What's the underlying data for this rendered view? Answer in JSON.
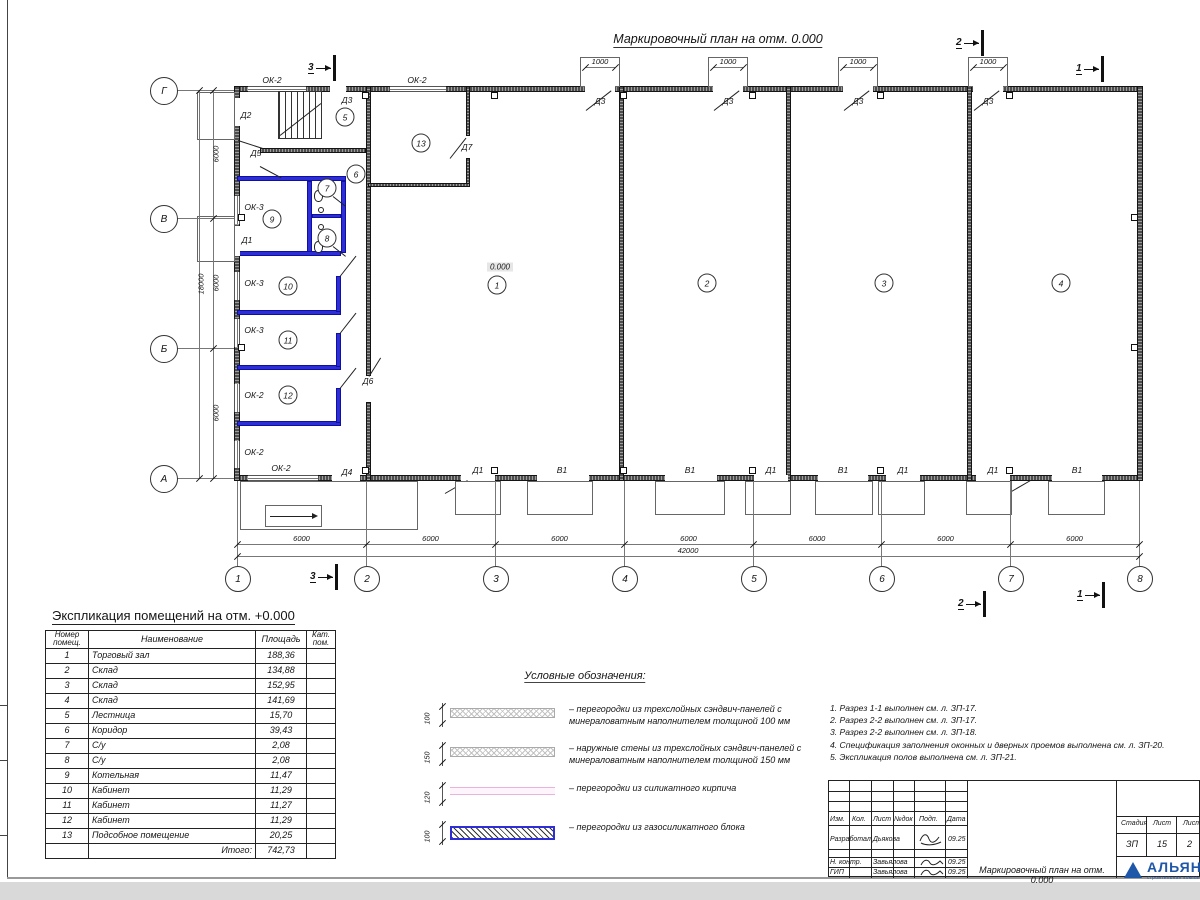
{
  "title": "Маркировочный план на отм. 0.000",
  "colors": {
    "wall_dark": "#4d4d4d",
    "wall_blue": "#2e2ed8",
    "legend_pink": "#e8b4dc",
    "logo_blue": "#1e57a8"
  },
  "plan": {
    "elevation_mark": "0.000",
    "grid_cols": [
      {
        "label": "1",
        "x": 237
      },
      {
        "label": "2",
        "x": 366
      },
      {
        "label": "3",
        "x": 495
      },
      {
        "label": "4",
        "x": 624
      },
      {
        "label": "5",
        "x": 753
      },
      {
        "label": "6",
        "x": 881
      },
      {
        "label": "7",
        "x": 1010
      },
      {
        "label": "8",
        "x": 1139
      }
    ],
    "grid_rows": [
      {
        "label": "Г",
        "y": 90
      },
      {
        "label": "В",
        "y": 218
      },
      {
        "label": "Б",
        "y": 348
      },
      {
        "label": "А",
        "y": 478
      }
    ],
    "bottom_dims": {
      "bay": "6000",
      "total": "42000"
    },
    "left_dims": {
      "bay": "6000",
      "total": "18000"
    },
    "top_openings": {
      "dim": "1000",
      "centers": [
        600,
        728,
        858,
        988
      ]
    },
    "room_circles": [
      {
        "n": "1",
        "x": 497,
        "y": 285
      },
      {
        "n": "2",
        "x": 707,
        "y": 283
      },
      {
        "n": "3",
        "x": 884,
        "y": 283
      },
      {
        "n": "4",
        "x": 1061,
        "y": 283
      },
      {
        "n": "5",
        "x": 345,
        "y": 117
      },
      {
        "n": "6",
        "x": 356,
        "y": 174
      },
      {
        "n": "7",
        "x": 327,
        "y": 188
      },
      {
        "n": "8",
        "x": 327,
        "y": 238
      },
      {
        "n": "9",
        "x": 272,
        "y": 219
      },
      {
        "n": "10",
        "x": 288,
        "y": 286
      },
      {
        "n": "11",
        "x": 288,
        "y": 340
      },
      {
        "n": "12",
        "x": 288,
        "y": 395
      },
      {
        "n": "13",
        "x": 421,
        "y": 143
      }
    ],
    "labels": [
      {
        "t": "ОК-2",
        "x": 272,
        "y": 80
      },
      {
        "t": "ОК-2",
        "x": 417,
        "y": 80
      },
      {
        "t": "Д3",
        "x": 347,
        "y": 100
      },
      {
        "t": "Д3",
        "x": 600,
        "y": 101
      },
      {
        "t": "Д3",
        "x": 728,
        "y": 101
      },
      {
        "t": "Д3",
        "x": 858,
        "y": 101
      },
      {
        "t": "Д3",
        "x": 988,
        "y": 101
      },
      {
        "t": "Д2",
        "x": 246,
        "y": 115
      },
      {
        "t": "Д5",
        "x": 256,
        "y": 153
      },
      {
        "t": "Д1",
        "x": 247,
        "y": 240
      },
      {
        "t": "ОК-3",
        "x": 254,
        "y": 207
      },
      {
        "t": "ОК-3",
        "x": 254,
        "y": 283
      },
      {
        "t": "ОК-3",
        "x": 254,
        "y": 330
      },
      {
        "t": "ОК-2",
        "x": 254,
        "y": 395
      },
      {
        "t": "ОК-2",
        "x": 254,
        "y": 452
      },
      {
        "t": "ОК-2",
        "x": 281,
        "y": 468
      },
      {
        "t": "Д4",
        "x": 347,
        "y": 472
      },
      {
        "t": "Д7",
        "x": 467,
        "y": 147
      },
      {
        "t": "Д6",
        "x": 368,
        "y": 381
      },
      {
        "t": "Д1",
        "x": 478,
        "y": 470
      },
      {
        "t": "В1",
        "x": 562,
        "y": 470
      },
      {
        "t": "В1",
        "x": 690,
        "y": 470
      },
      {
        "t": "Д1",
        "x": 771,
        "y": 470
      },
      {
        "t": "В1",
        "x": 843,
        "y": 470
      },
      {
        "t": "Д1",
        "x": 903,
        "y": 470
      },
      {
        "t": "Д1",
        "x": 993,
        "y": 470
      },
      {
        "t": "В1",
        "x": 1077,
        "y": 470
      }
    ],
    "section_markers": [
      {
        "label": "3",
        "x": 308,
        "y": 68
      },
      {
        "label": "2",
        "x": 956,
        "y": 43
      },
      {
        "label": "1",
        "x": 1076,
        "y": 69
      },
      {
        "label": "3",
        "x": 310,
        "y": 577
      },
      {
        "label": "2",
        "x": 958,
        "y": 604
      },
      {
        "label": "1",
        "x": 1077,
        "y": 595
      }
    ]
  },
  "table": {
    "title": "Экспликация помещений на отм. +0.000",
    "headers": [
      "Номер помещ.",
      "Наименование",
      "Площадь",
      "Кат. пом."
    ],
    "rows": [
      [
        "1",
        "Торговый зал",
        "188,36"
      ],
      [
        "2",
        "Склад",
        "134,88"
      ],
      [
        "3",
        "Склад",
        "152,95"
      ],
      [
        "4",
        "Склад",
        "141,69"
      ],
      [
        "5",
        "Лестница",
        "15,70"
      ],
      [
        "6",
        "Коридор",
        "39,43"
      ],
      [
        "7",
        "С/у",
        "2,08"
      ],
      [
        "8",
        "С/у",
        "2,08"
      ],
      [
        "9",
        "Котельная",
        "11,47"
      ],
      [
        "10",
        "Кабинет",
        "11,29"
      ],
      [
        "11",
        "Кабинет",
        "11,27"
      ],
      [
        "12",
        "Кабинет",
        "11,29"
      ],
      [
        "13",
        "Подсобное помещение",
        "20,25"
      ]
    ],
    "total_label": "Итого:",
    "total_value": "742,73"
  },
  "legend": {
    "title": "Условные обозначения:",
    "items": [
      {
        "dim": "100",
        "style": "sandwich",
        "text": "– перегородки из трехслойных сэндвич-панелей с минераловатным наполнителем толщиной 100 мм"
      },
      {
        "dim": "150",
        "style": "sandwich",
        "text": "– наружные стены из трехслойных сэндвич-панелей с минераловатным наполнителем толщиной 150 мм"
      },
      {
        "dim": "120",
        "style": "brick",
        "text": "– перегородки из силикатного кирпича"
      },
      {
        "dim": "100",
        "style": "gasblock",
        "text": "– перегородки из газосиликатного блока"
      }
    ]
  },
  "notes": [
    "1. Разрез 1-1 выполнен см. л. ЗП-17.",
    "2. Разрез 2-2 выполнен см. л. ЗП-17.",
    "3. Разрез 2-2 выполнен см. л. ЗП-18.",
    "4. Спецификация заполнения оконных и дверных проемов выполнена см. л. ЗП-20.",
    "5. Экспликация полов выполнена см. л. ЗП-21."
  ],
  "stamp": {
    "cols": [
      "Изм.",
      "Кол.",
      "Лист",
      "№док",
      "Подп.",
      "Дата"
    ],
    "rows": [
      {
        "role": "Разработал",
        "name": "Дьякова",
        "date": "09.25"
      },
      {
        "role": "Н. контр.",
        "name": "Завьялова",
        "date": "09.25"
      },
      {
        "role": "ГИП",
        "name": "Завьялова",
        "date": "09.25"
      }
    ],
    "doc_title": "Маркировочный план на отм. 0.000",
    "stage": {
      "labels": [
        "Стадия",
        "Лист",
        "Листов"
      ],
      "values": [
        "ЗП",
        "15",
        "2"
      ]
    },
    "logo": {
      "word": "АЛЬЯНС",
      "sub": "строительная компания"
    }
  }
}
